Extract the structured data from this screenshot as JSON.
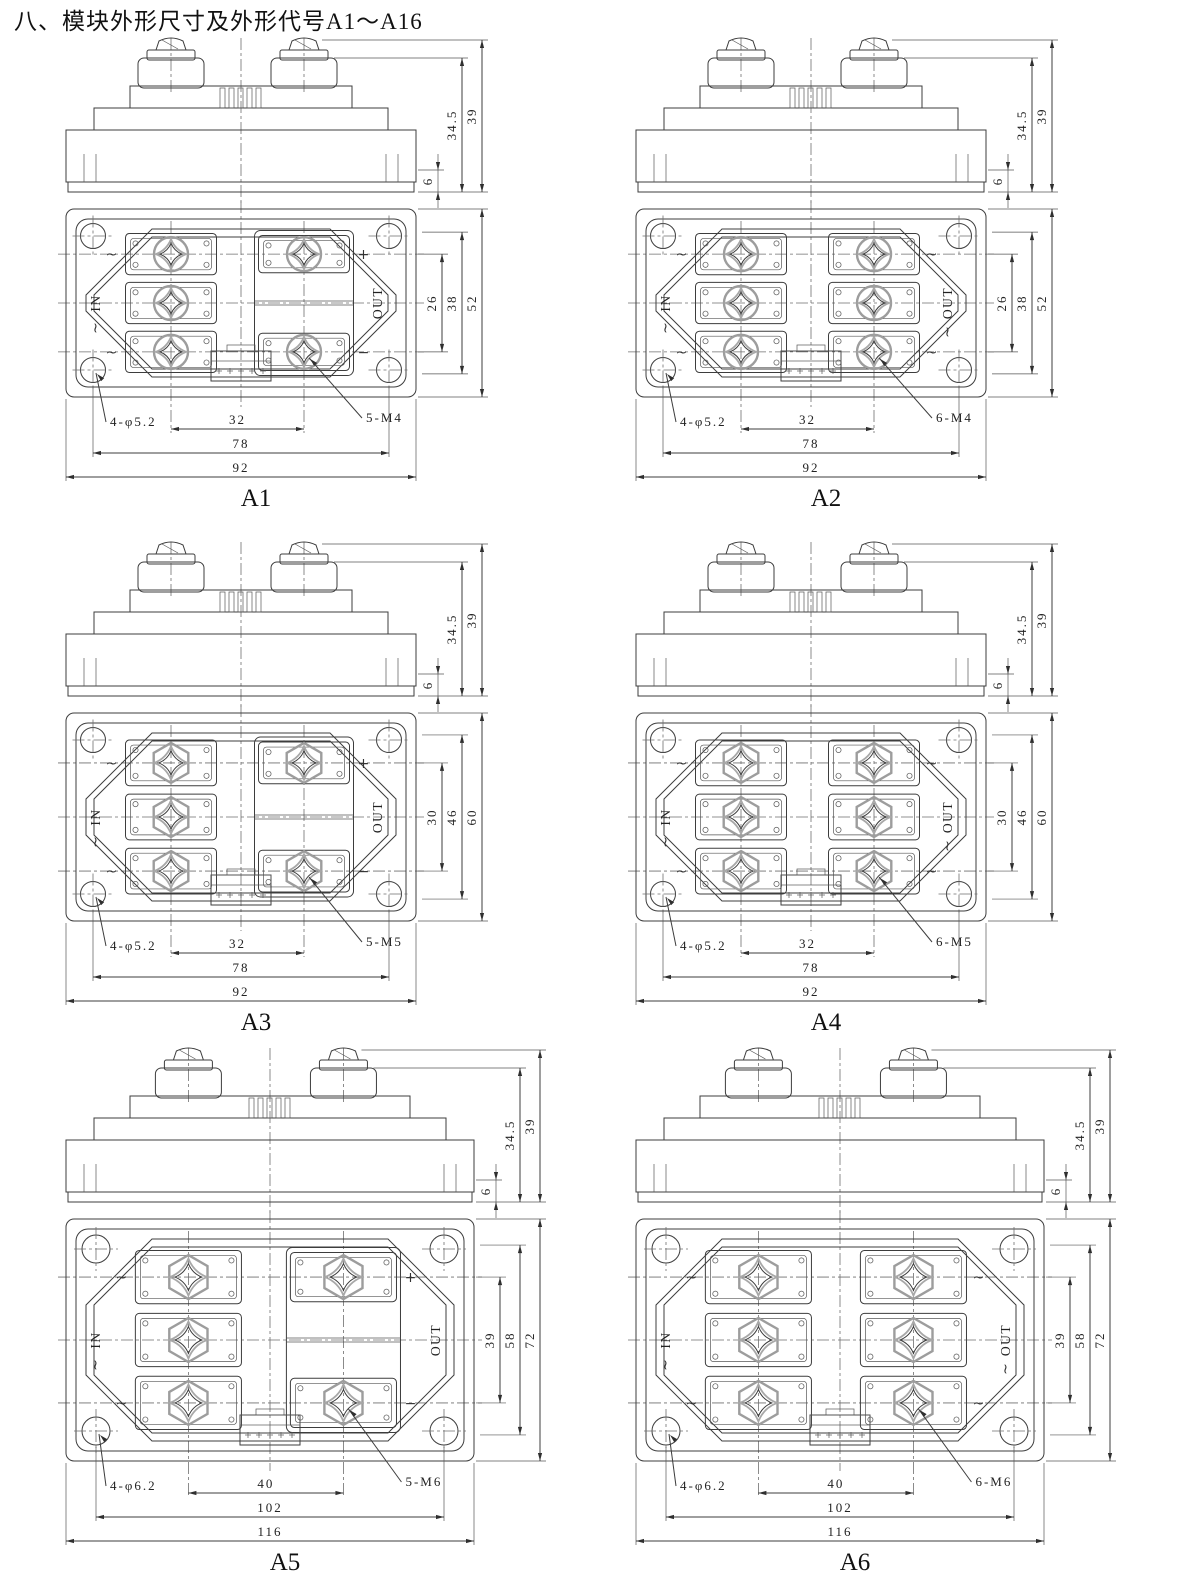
{
  "page": {
    "title": "八、模块外形尺寸及外形代号A1～A16"
  },
  "colors": {
    "background": "#ffffff",
    "line": "#3d3d3d",
    "screw_accent": "#9d9d9d",
    "centerline": "#6f6f6f"
  },
  "figures": [
    {
      "label": "A1",
      "in_label": "IN",
      "out_label": "OUT",
      "left_marks": [
        "~",
        "~",
        "~"
      ],
      "right_marks": [
        "+",
        "−"
      ],
      "right_terminal_count": 2,
      "side_dims": {
        "tab": "6",
        "body": "34.5",
        "total": "39"
      },
      "vert_dims": {
        "inner": "26",
        "mid": "38",
        "outer": "52"
      },
      "holes_label": "4-φ5.2",
      "pitch_label": "32",
      "screws_label": "5-M4",
      "mid_width": "78",
      "outer_width": "92"
    },
    {
      "label": "A2",
      "in_label": "IN",
      "out_label": "OUT",
      "left_marks": [
        "~",
        "~",
        "~"
      ],
      "right_marks": [
        "~",
        "~",
        "~"
      ],
      "right_terminal_count": 3,
      "side_dims": {
        "tab": "6",
        "body": "34.5",
        "total": "39"
      },
      "vert_dims": {
        "inner": "26",
        "mid": "38",
        "outer": "52"
      },
      "holes_label": "4-φ5.2",
      "pitch_label": "32",
      "screws_label": "6-M4",
      "mid_width": "78",
      "outer_width": "92"
    },
    {
      "label": "A3",
      "in_label": "IN",
      "out_label": "OUT",
      "left_marks": [
        "~",
        "~",
        "~"
      ],
      "right_marks": [
        "+",
        "−"
      ],
      "right_terminal_count": 2,
      "side_dims": {
        "tab": "6",
        "body": "34.5",
        "total": "39"
      },
      "vert_dims": {
        "inner": "30",
        "mid": "46",
        "outer": "60"
      },
      "holes_label": "4-φ5.2",
      "pitch_label": "32",
      "screws_label": "5-M5",
      "mid_width": "78",
      "outer_width": "92"
    },
    {
      "label": "A4",
      "in_label": "IN",
      "out_label": "OUT",
      "left_marks": [
        "~",
        "~",
        "~"
      ],
      "right_marks": [
        "~",
        "~",
        "~"
      ],
      "right_terminal_count": 3,
      "side_dims": {
        "tab": "6",
        "body": "34.5",
        "total": "39"
      },
      "vert_dims": {
        "inner": "30",
        "mid": "46",
        "outer": "60"
      },
      "holes_label": "4-φ5.2",
      "pitch_label": "32",
      "screws_label": "6-M5",
      "mid_width": "78",
      "outer_width": "92"
    },
    {
      "label": "A5",
      "in_label": "IN",
      "out_label": "OUT",
      "left_marks": [
        "~",
        "~",
        "~"
      ],
      "right_marks": [
        "+",
        "−"
      ],
      "right_terminal_count": 2,
      "side_dims": {
        "tab": "6",
        "body": "34.5",
        "total": "39"
      },
      "vert_dims": {
        "inner": "39",
        "mid": "58",
        "outer": "72"
      },
      "holes_label": "4-φ6.2",
      "pitch_label": "40",
      "screws_label": "5-M6",
      "mid_width": "102",
      "outer_width": "116"
    },
    {
      "label": "A6",
      "in_label": "IN",
      "out_label": "OUT",
      "left_marks": [
        "~",
        "~",
        "~"
      ],
      "right_marks": [
        "~",
        "~",
        "~"
      ],
      "right_terminal_count": 3,
      "side_dims": {
        "tab": "6",
        "body": "34.5",
        "total": "39"
      },
      "vert_dims": {
        "inner": "39",
        "mid": "58",
        "outer": "72"
      },
      "holes_label": "4-φ6.2",
      "pitch_label": "40",
      "screws_label": "6-M6",
      "mid_width": "102",
      "outer_width": "116"
    }
  ]
}
